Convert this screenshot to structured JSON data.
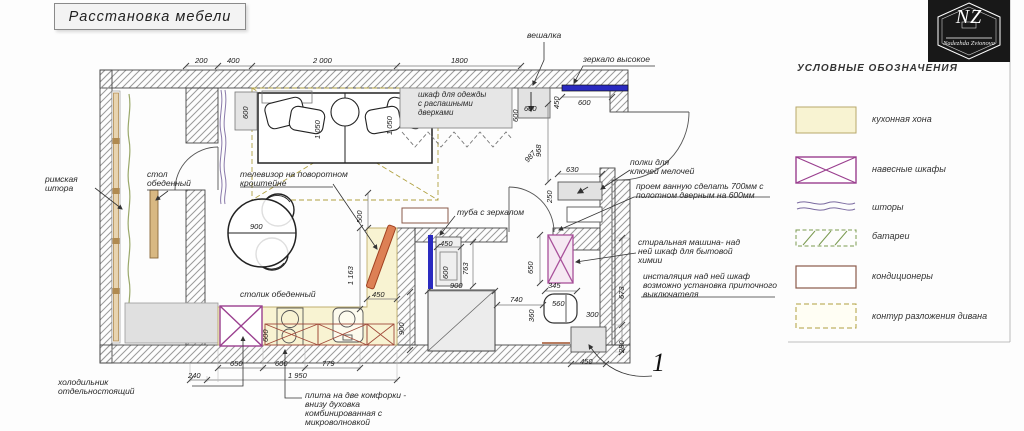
{
  "title": "Расстановка мебели",
  "logo": {
    "monogram": "NZ",
    "name": "Nadezhda Zvionova"
  },
  "legend": {
    "header": "УСЛОВНЫЕ ОБОЗНАЧЕНИЯ",
    "items": [
      {
        "id": "kitchen-zone",
        "label": "кухонная хона"
      },
      {
        "id": "wall-cabinets",
        "label": "навесные шкафы"
      },
      {
        "id": "curtains",
        "label": "шторы"
      },
      {
        "id": "radiators",
        "label": "батареи"
      },
      {
        "id": "air-conditioners",
        "label": "кондиционеры"
      },
      {
        "id": "sofa-unfold-contour",
        "label": "контур разложения дивана"
      }
    ]
  },
  "annotations": {
    "hanger": "вешалка",
    "tall_mirror": "зеркало высокое",
    "wardrobe_l1": "шкаф для одежды",
    "wardrobe_l2": "с распашными",
    "wardrobe_l3": "дверками",
    "tv_l1": "телевизор на поворотном",
    "tv_l2": "кроштейне",
    "vanity": "туба с зеркалом",
    "roman_blind_l1": "римская",
    "roman_blind_l2": "штора",
    "window_table_l1": "стол",
    "window_table_l2": "обеденный",
    "round_table": "столик обеденный",
    "fridge_l1": "холодильник",
    "fridge_l2": "отдельностоящий",
    "stove_l1": "плита на две комфорки -",
    "stove_l2": "внизу духовка",
    "stove_l3": "комбинированная с",
    "stove_l4": "микроволновкой",
    "shelves_l1": "полки для",
    "shelves_l2": "ключей мелочей",
    "opening_l1": "проем  ванную сделать 700мм с",
    "opening_l2": "полотном дверным на 600мм",
    "washer_l1": "стиральная машина- над",
    "washer_l2": "ней шкаф для бытовой",
    "washer_l3": "химии",
    "inst_l1": "инсталяция над ней шкаф",
    "inst_l2": "возможно установка приточного",
    "inst_l3": "выключателя",
    "sheet_no": "1"
  },
  "dims": {
    "top_1": "200",
    "top_2": "400",
    "top_3": "2 000",
    "top_4": "1800",
    "bedside": "600",
    "bed_left": "1 050",
    "bed_right": "1 050",
    "wardrobe_d": "600",
    "mirror_w": "600",
    "mirror_side": "450",
    "hanger_w": "600",
    "hall_len": "968",
    "hall_diag": "987",
    "shelves_w": "630",
    "shelves_d": "250",
    "tv_gap": "500",
    "kitchen_len": "1 163",
    "kitchen_w": "450",
    "counter_d": "600",
    "fridge_w": "650",
    "stove_w": "600",
    "counter_1": "779",
    "counter_2": "240",
    "counter_total": "1 950",
    "bath_d": "900",
    "shower_w": "900",
    "vanity_w": "450",
    "vanity_d": "600",
    "vanity_gap": "763",
    "washer_h": "650",
    "toilet_clear": "740",
    "toilet_w": "345",
    "toilet_side": "360",
    "toilet_len": "560",
    "inst_side": "300",
    "inst_w": "450",
    "wall_seg1": "673",
    "wall_seg2": "280",
    "table_dia": "900"
  },
  "colors": {
    "kitchen_zone": "#f8f3d2",
    "wall_cabinet": "#9a3f8f",
    "counter_cabinet": "#a04a3a",
    "mirror_blue": "#2a2ac0",
    "tv_orange": "#dd8055",
    "sofa_contour": "#b0a040",
    "radiator_green": "#7a9a50",
    "curtain_purple": "#7a6aa0",
    "curtain_green": "#9aa86a",
    "ac_brown": "#8a5a4a"
  }
}
